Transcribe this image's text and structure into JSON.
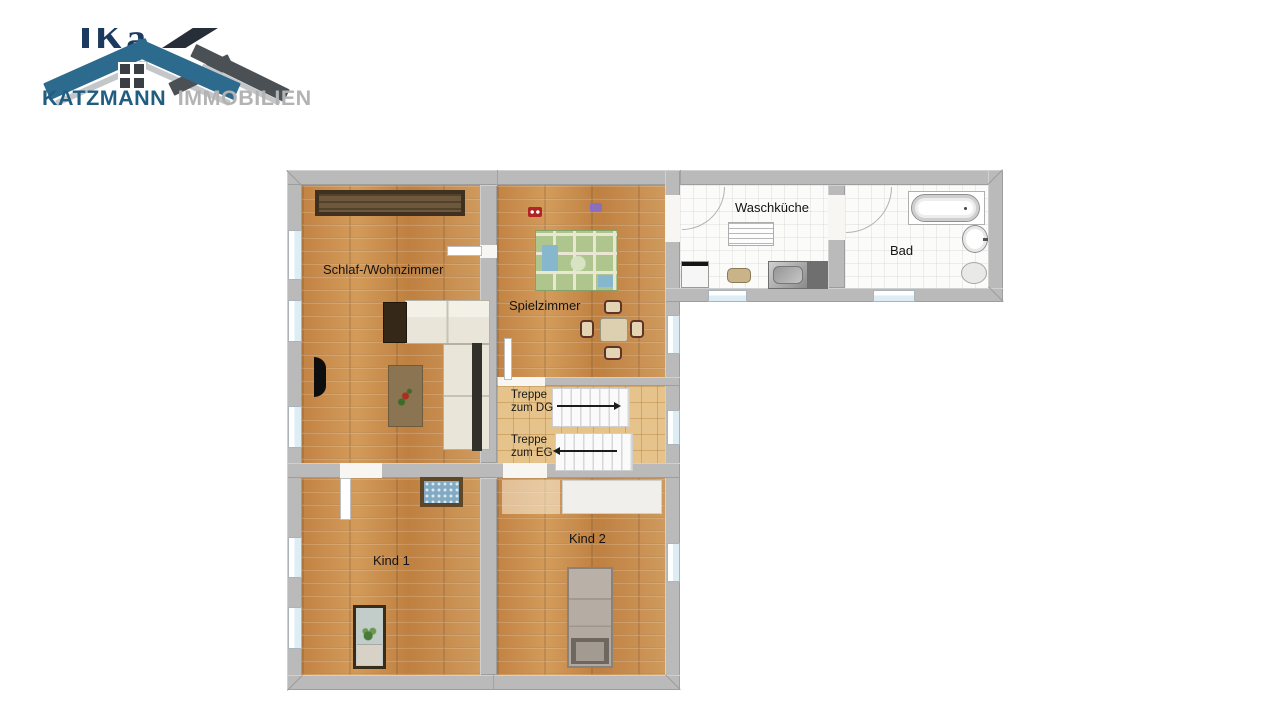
{
  "logo": {
    "company": "KATZMANN",
    "suffix": "IMMOBILIEN",
    "watermark_fragment": "Ka",
    "colors": {
      "roof_blue": "#2d6b8e",
      "roof_dark": "#4b5055",
      "company_text": "#1f5e80",
      "suffix_text": "#b3b3b3"
    }
  },
  "floorplan": {
    "rooms": [
      {
        "id": "schlaf-wohnzimmer",
        "label": "Schlaf-/Wohnzimmer",
        "floor": "wood"
      },
      {
        "id": "spielzimmer",
        "label": "Spielzimmer",
        "floor": "wood"
      },
      {
        "id": "waschkueche",
        "label": "Waschküche",
        "floor": "tile"
      },
      {
        "id": "bad",
        "label": "Bad",
        "floor": "tile"
      },
      {
        "id": "kind-1",
        "label": "Kind 1",
        "floor": "wood"
      },
      {
        "id": "kind-2",
        "label": "Kind 2",
        "floor": "wood"
      }
    ],
    "stairs": [
      {
        "line1": "Treppe",
        "line2": "zum DG",
        "direction": "right"
      },
      {
        "line1": "Treppe",
        "line2": "zum EG",
        "direction": "left"
      }
    ],
    "colors": {
      "wall": "#bababa",
      "wood_floor": "#c8904f",
      "stair_floor": "#e6c38b",
      "tile_floor": "#fbfbfa",
      "window": "#dcedf6"
    }
  }
}
